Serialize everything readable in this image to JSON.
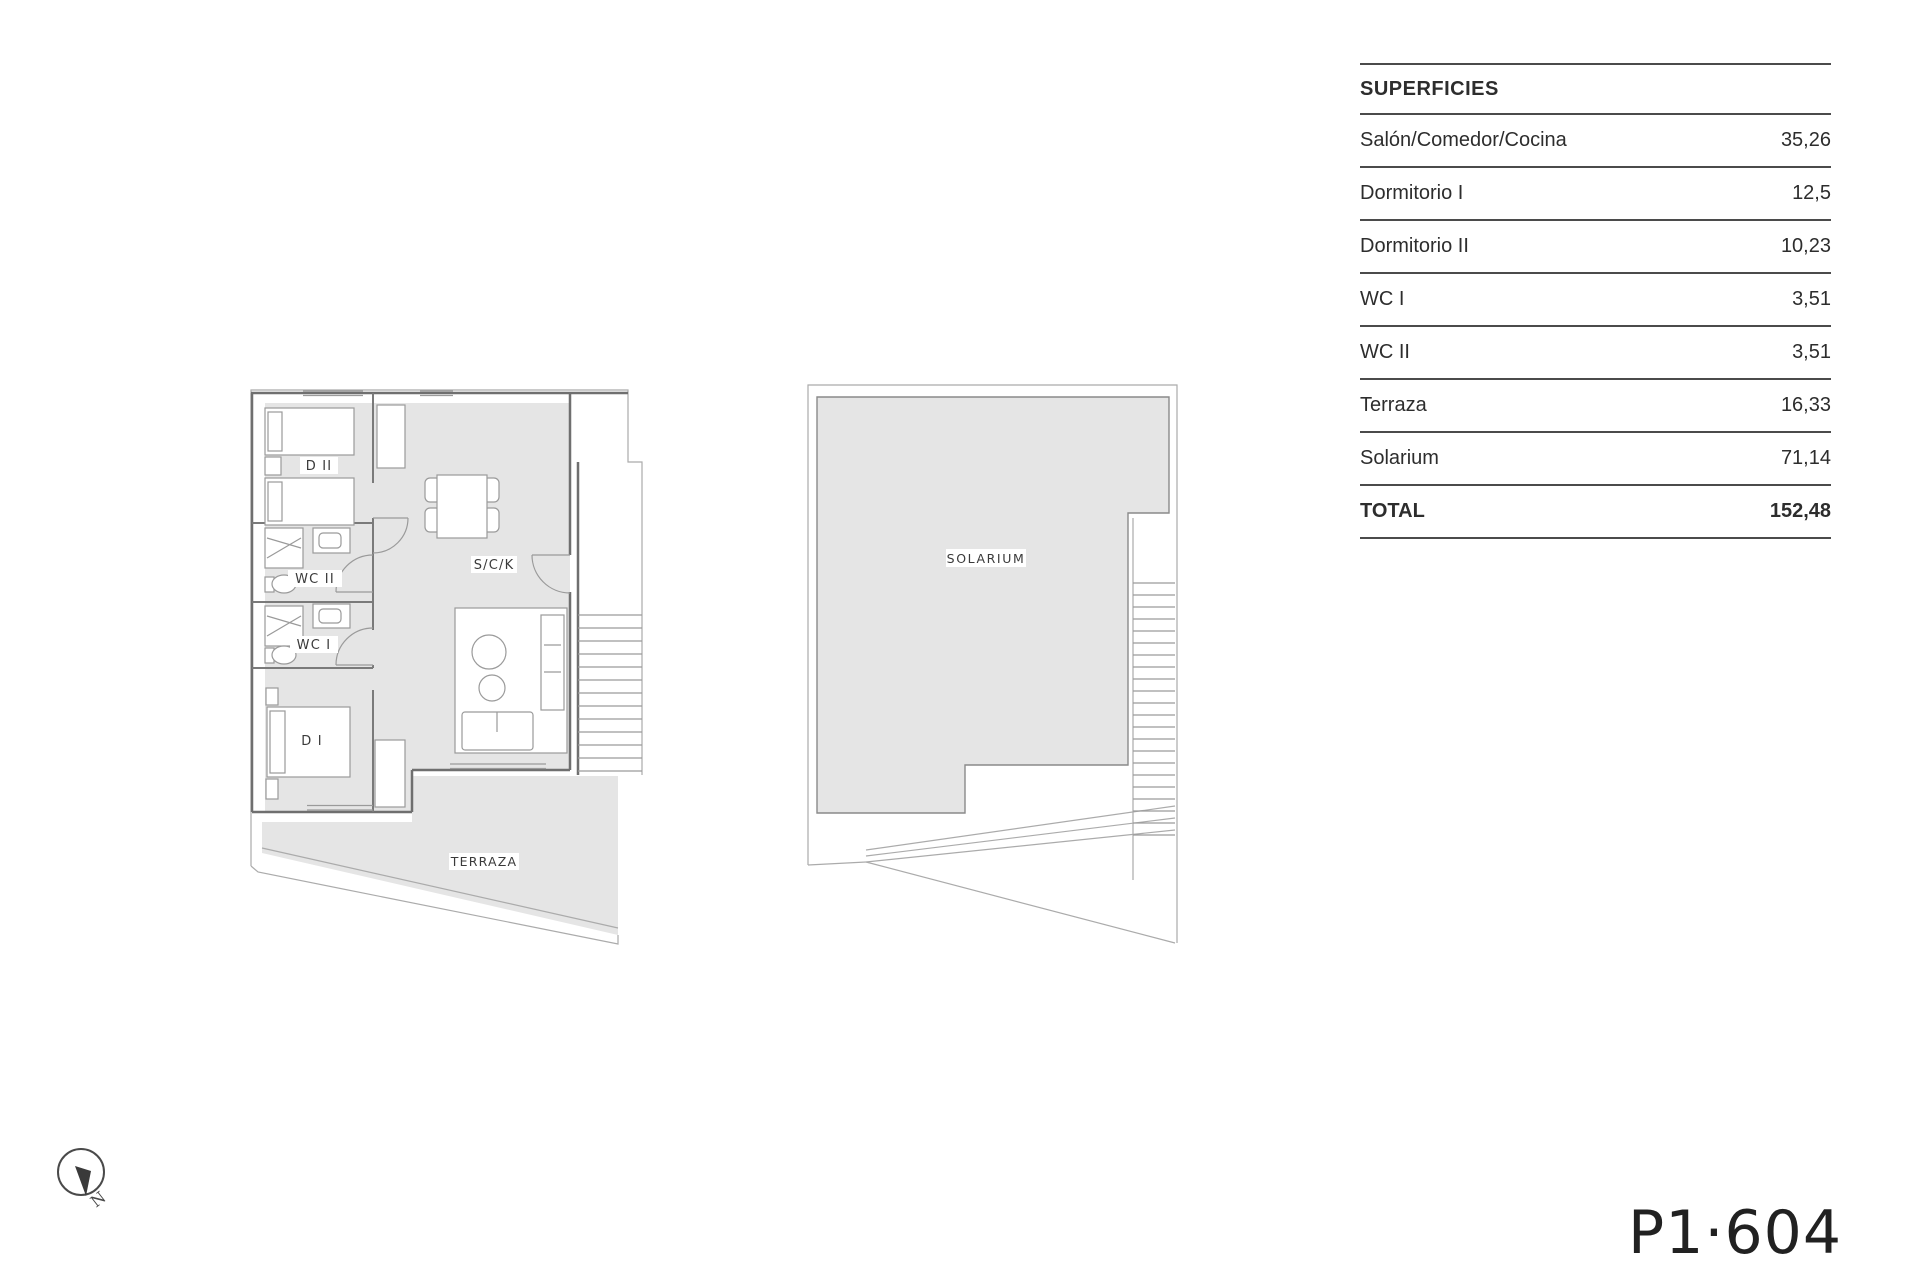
{
  "page": {
    "plan_code": "P1·604"
  },
  "surfaces_table": {
    "header": "SUPERFICIES",
    "rows": [
      {
        "label": "Salón/Comedor/Cocina",
        "value": "35,26"
      },
      {
        "label": "Dormitorio I",
        "value": "12,5"
      },
      {
        "label": "Dormitorio II",
        "value": "10,23"
      },
      {
        "label": "WC I",
        "value": "3,51"
      },
      {
        "label": "WC II",
        "value": "3,51"
      },
      {
        "label": "Terraza",
        "value": "16,33"
      },
      {
        "label": "Solarium",
        "value": "71,14"
      }
    ],
    "total": {
      "label": "TOTAL",
      "value": "152,48"
    }
  },
  "floor_plan": {
    "labels": {
      "dormitorio2": "D II",
      "wc2": "WC II",
      "wc1": "WC I",
      "dormitorio1": "D I",
      "salon_comedor_cocina": "S/C/K",
      "terraza": "TERRAZA"
    }
  },
  "solarium_plan": {
    "label": "SOLARIUM"
  },
  "compass": {
    "north_label": "N"
  },
  "colors": {
    "floor_fill": "#e5e5e5",
    "wall_line": "#6f6f6f",
    "table_line": "#4b4b4b",
    "text": "#2d2d2d"
  }
}
